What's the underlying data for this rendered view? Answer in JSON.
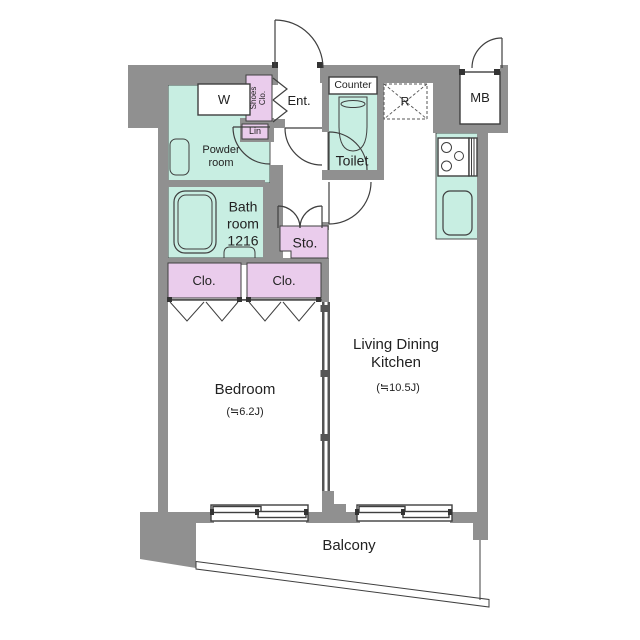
{
  "plan": {
    "labels": {
      "bedroom": "Bedroom",
      "bedroom_size": "(≒6.2J)",
      "ldk_line1": "Living Dining",
      "ldk_line2": "Kitchen",
      "ldk_size": "(≒10.5J)",
      "bath_line1": "Bath",
      "bath_line2": "room",
      "bath_line3": "1216",
      "powder_line1": "Powder",
      "powder_line2": "room",
      "toilet": "Toilet",
      "counter": "Counter",
      "entrance": "Ent.",
      "storage": "Sto.",
      "closet_left": "Clo.",
      "closet_right": "Clo.",
      "shoes_line1": "Shoes",
      "shoes_line2": "Clo.",
      "linen": "Lin",
      "washer": "W",
      "fridge": "R",
      "meter_box": "MB",
      "balcony": "Balcony"
    },
    "colors": {
      "wall": "#909090",
      "wet_area": "#c8eee2",
      "storage_area": "#eaccec",
      "line": "#3f3f3f",
      "text": "#222222"
    }
  }
}
